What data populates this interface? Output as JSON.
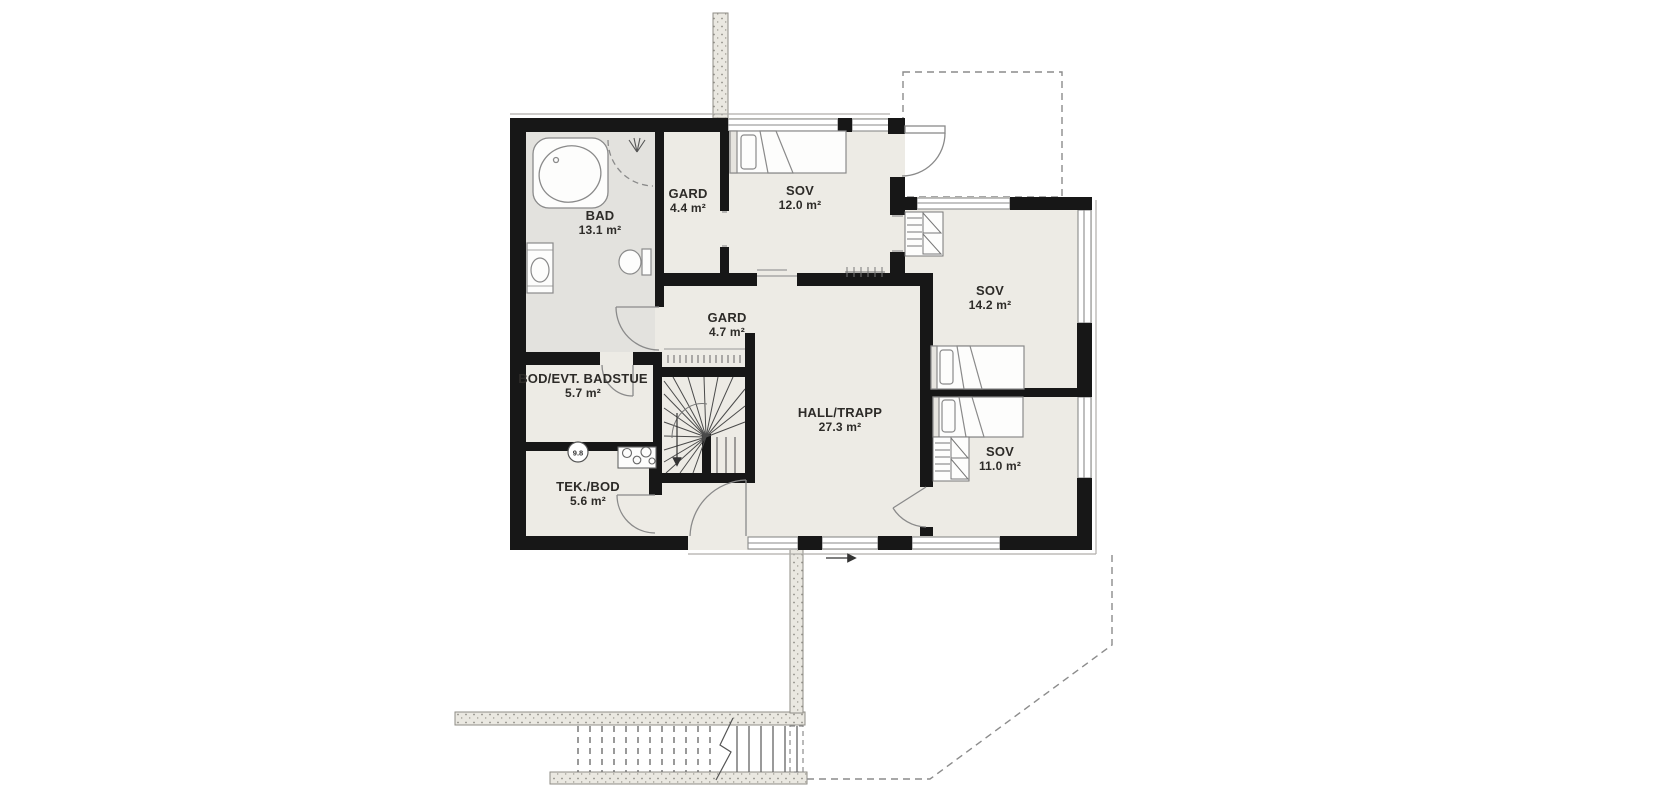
{
  "plan": {
    "rooms": [
      {
        "id": "bad",
        "name": "BAD",
        "area": "13.1 m²"
      },
      {
        "id": "gard44",
        "name": "GARD",
        "area": "4.4 m²"
      },
      {
        "id": "sov12",
        "name": "SOV",
        "area": "12.0 m²"
      },
      {
        "id": "gard47",
        "name": "GARD",
        "area": "4.7 m²"
      },
      {
        "id": "hall",
        "name": "HALL/TRAPP",
        "area": "27.3 m²"
      },
      {
        "id": "bod",
        "name": "BOD/EVT. BADSTUE",
        "area": "5.7 m²"
      },
      {
        "id": "tek",
        "name": "TEK./BOD",
        "area": "5.6 m²"
      },
      {
        "id": "sov142",
        "name": "SOV",
        "area": "14.2 m²"
      },
      {
        "id": "sov11",
        "name": "SOV",
        "area": "11.0 m²"
      }
    ],
    "markers": {
      "elevation": "9.8"
    },
    "colors": {
      "wall": "#171717",
      "floor": "#edebe5",
      "bath_floor": "#e3e2de",
      "furniture_outline": "#8a8a8a",
      "dashed_line": "#8c8c8c",
      "stipple_fill": "#eae8e1"
    }
  }
}
